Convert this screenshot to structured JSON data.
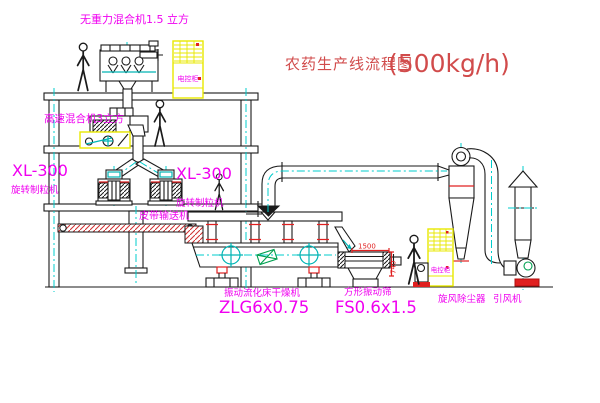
{
  "title": {
    "text": "农药生产线流程图",
    "capacity": "(500kg/h)"
  },
  "labels": {
    "gravity_mixer": "无重力混合机1.5 立方",
    "high_speed_mixer": "高速混合机3立方",
    "granulator_left_model": "XL-300",
    "granulator_left_name": "旋转制粒机",
    "granulator_right_model": "XL-300",
    "granulator_right_name": "旋转制粒机",
    "belt_conveyor": "皮带输送机",
    "dryer_name": "振动流化床干燥机",
    "dryer_model": "ZLG6x0.75",
    "screen_name": "方形振动筛",
    "screen_model": "FS0.6x1.5",
    "cyclone": "旋风除尘器",
    "fan": "引风机",
    "cabinet_top": "电控柜",
    "cabinet_bottom": "电控柜",
    "dim_width": "1500",
    "dim_height": "740"
  },
  "colors": {
    "label_magenta": "#f000f0",
    "title_red": "#d14b4b",
    "centerline_cyan": "#00cccc",
    "cabinet_yellow": "#e8e800",
    "detail_red": "#e02020",
    "motor_green": "#00a050",
    "line_black": "#1a1a1a"
  }
}
